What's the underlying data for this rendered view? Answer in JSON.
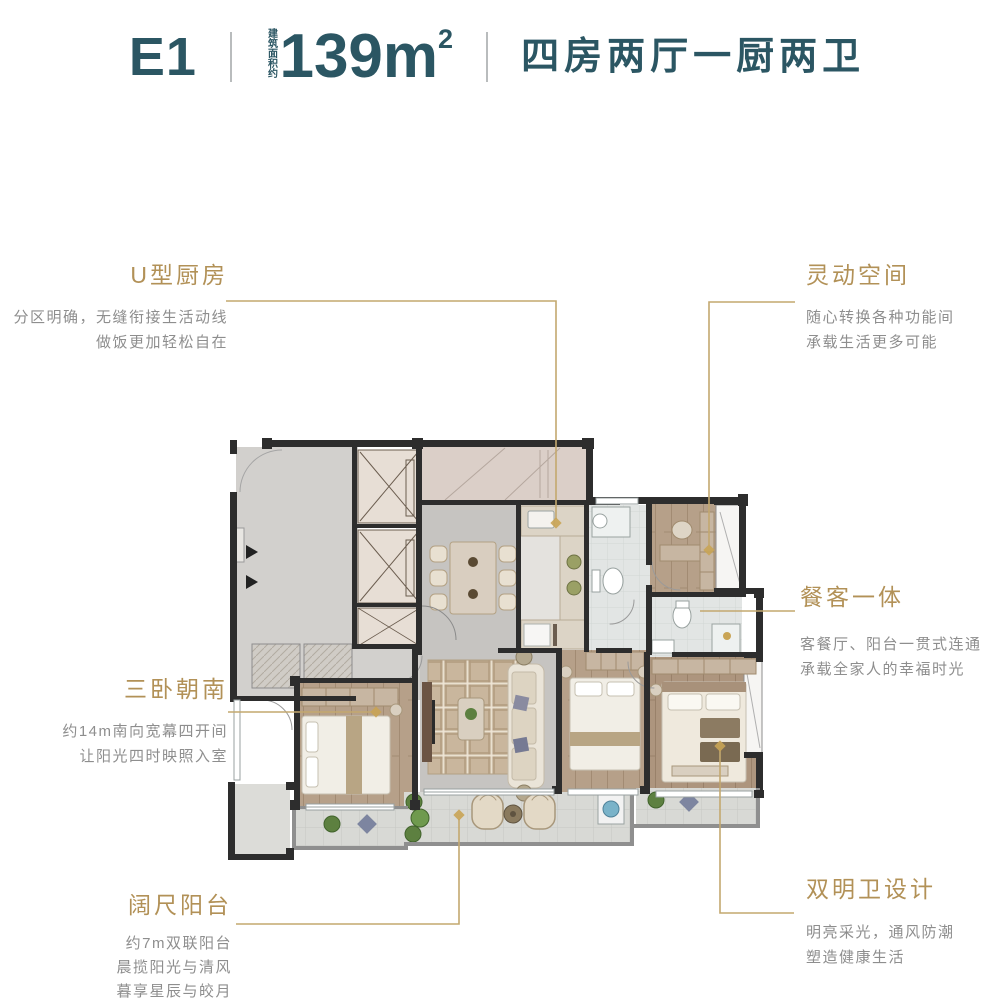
{
  "header": {
    "unit_name": "E1",
    "area_label": "建筑面积约",
    "area_value": "139m",
    "area_exponent": "2",
    "rooms_summary": "四房两厅一厨两卫"
  },
  "callouts": {
    "kitchen": {
      "title": "U型厨房",
      "lines": [
        "分区明确，无缝衔接生活动线",
        "做饭更加轻松自在"
      ]
    },
    "flex_space": {
      "title": "灵动空间",
      "lines": [
        "随心转换各种功能间",
        "承载生活更多可能"
      ]
    },
    "dining_living": {
      "title": "餐客一体",
      "lines": [
        "客餐厅、阳台一贯式连通",
        "承载全家人的幸福时光"
      ]
    },
    "south_bedrooms": {
      "title": "三卧朝南",
      "lines": [
        "约14m南向宽幕四开间",
        "让阳光四时映照入室"
      ]
    },
    "balcony": {
      "title": "阔尺阳台",
      "lines": [
        "约7m双联阳台",
        "晨揽阳光与清风",
        "暮享星辰与皎月"
      ]
    },
    "bathrooms": {
      "title": "双明卫设计",
      "lines": [
        "明亮采光，通风防潮",
        "塑造健康生活"
      ]
    }
  },
  "colors": {
    "accent_teal": "#2b5663",
    "callout_title_gold": "#b29157",
    "leader_line_gold": "#c3a86f",
    "description_gray": "#8e8e8e"
  }
}
